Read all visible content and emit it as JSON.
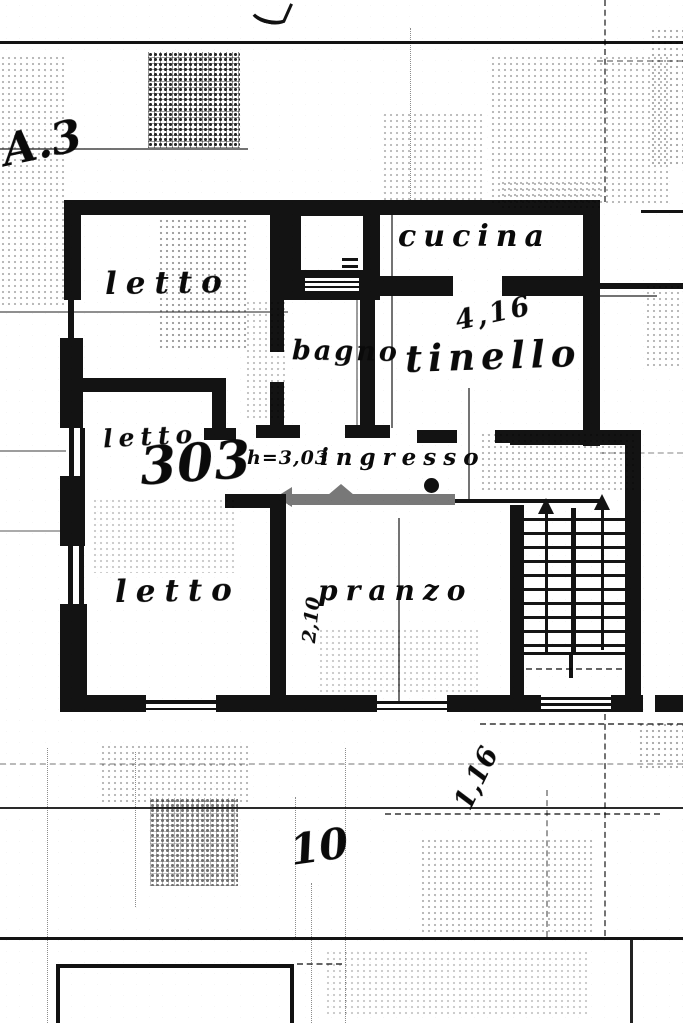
{
  "plan": {
    "reference": "A.3",
    "rooms": {
      "letto_top": "letto",
      "cucina": "cucina",
      "tinello": "tinello",
      "bagno": "bagno",
      "letto_mid": "letto",
      "letto_mid_number": "303",
      "ingresso_height": "h=3,03",
      "ingresso": "ingresso",
      "letto_bottom": "letto",
      "pranzo": "pranzo"
    },
    "measurements": {
      "tinello_width": "4,16",
      "pranzo_width": "2,10",
      "right_offset": "1,16",
      "sheet_number": "10"
    },
    "colors": {
      "ink": "#131313",
      "door_mark_gray": "#787878",
      "paper": "#ffffff"
    }
  }
}
